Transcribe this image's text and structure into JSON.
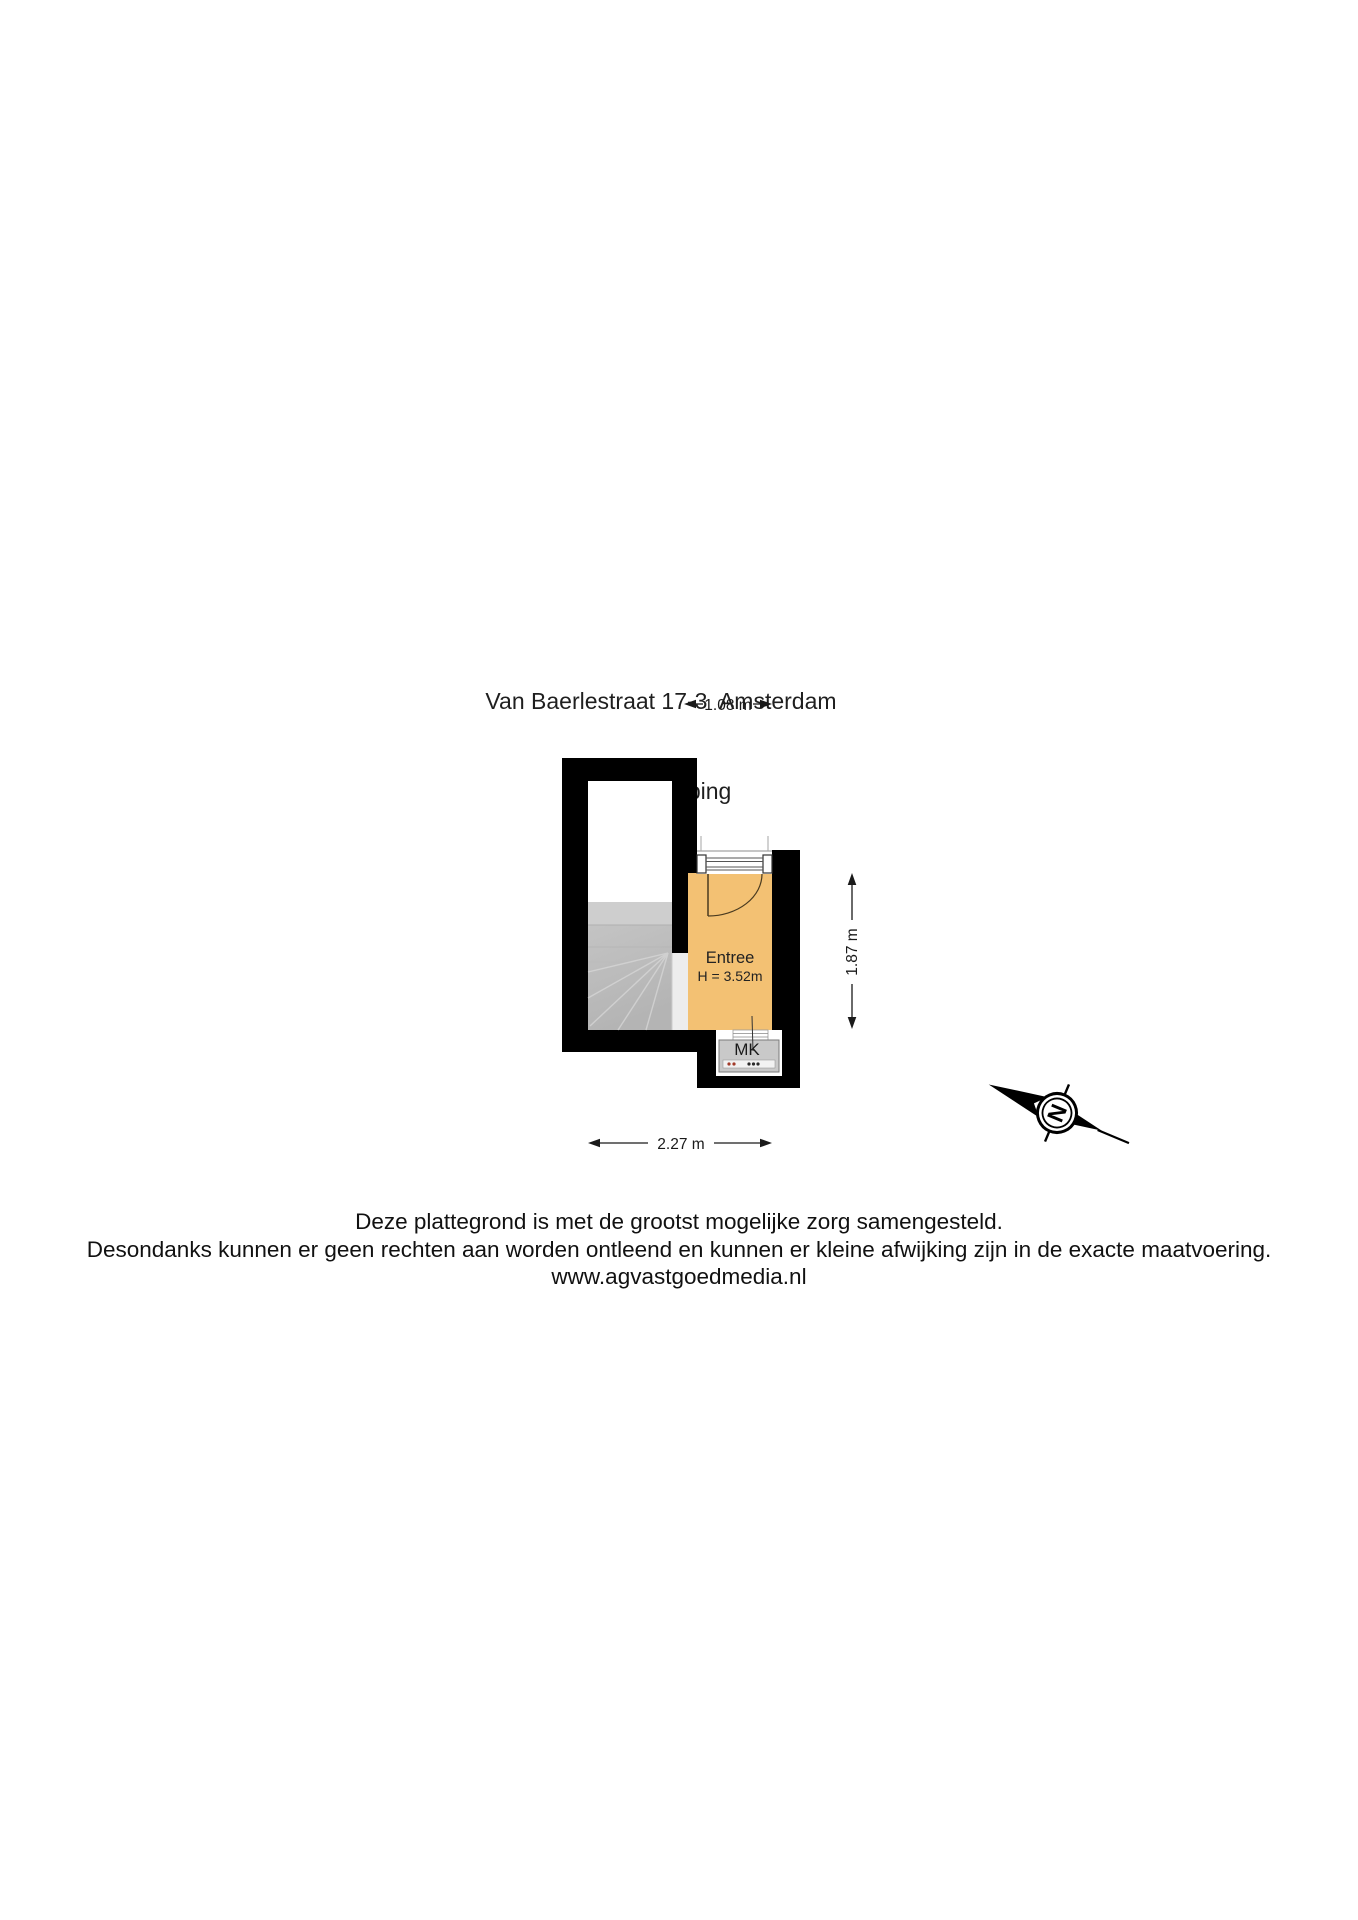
{
  "title": {
    "line1": "Van Baerlestraat 17-3  Amsterdam",
    "line2": "2e Verdieping"
  },
  "floorplan": {
    "room_name": "Entree",
    "room_height": "H = 3.52m",
    "closet_label": "MK",
    "dim_top": "1.08 m",
    "dim_right": "1.87 m",
    "dim_bottom": "2.27 m",
    "compass_label": "N",
    "colors": {
      "wall": "#000000",
      "room_fill": "#f3c173",
      "stairs_fill": "#c6c6c6",
      "closet_fill": "#c9c9c9"
    }
  },
  "footer": {
    "line1": "Deze plattegrond is met de grootst mogelijke zorg samengesteld.",
    "line2": "Desondanks kunnen er geen rechten aan worden ontleend en kunnen er kleine afwijking zijn in de exacte maatvoering.",
    "line3": "www.agvastgoedmedia.nl"
  }
}
